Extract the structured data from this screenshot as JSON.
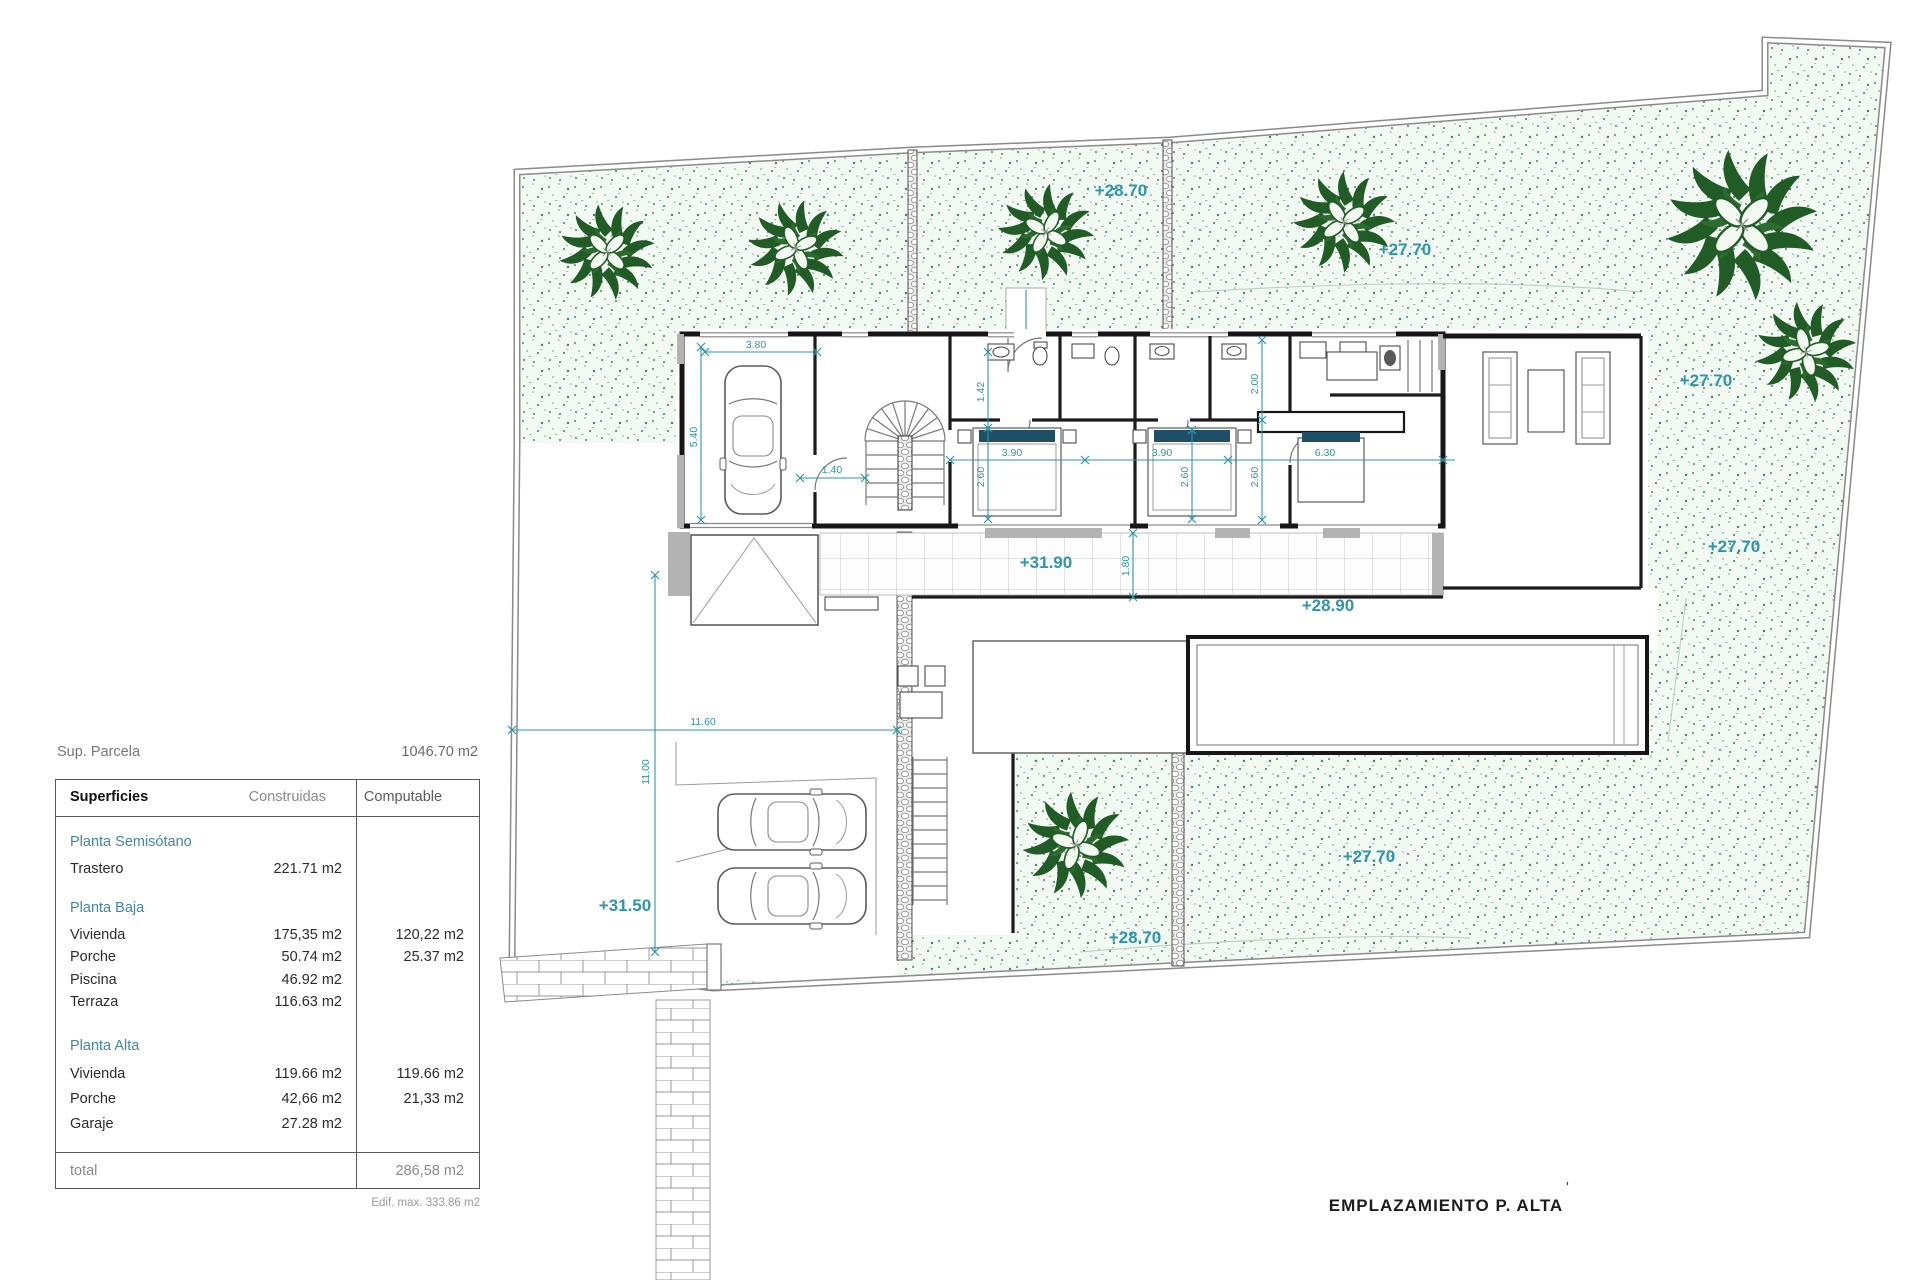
{
  "colors": {
    "garden_fill": "#f2f9f3",
    "plant_green": "#215b25",
    "dimension_teal": "#2e96ab",
    "section_title_blue": "#3e87a8",
    "wall_black": "#161616",
    "pillow_navy": "#1d4f66",
    "poche_grey": "#b3b3b3",
    "boundary_grey": "#8a8a8a"
  },
  "panel": {
    "sup_parcela_label": "Sup. Parcela",
    "sup_parcela_value": "1046.70 m2",
    "table": {
      "col_headers": {
        "superficies": "Superficies",
        "construidas": "Construidas",
        "computable": "Computable"
      },
      "sections": [
        {
          "title": "Planta Semisótano",
          "rows": [
            {
              "name": "Trastero",
              "construidas": "221.71 m2",
              "computable": ""
            }
          ]
        },
        {
          "title": "Planta Baja",
          "rows": [
            {
              "name": "Vivienda",
              "construidas": "175,35 m2",
              "computable": "120,22 m2"
            },
            {
              "name": "Porche",
              "construidas": "50.74 m2",
              "computable": "25.37 m2"
            },
            {
              "name": "Piscina",
              "construidas": "46.92 m2",
              "computable": ""
            },
            {
              "name": "Terraza",
              "construidas": "116.63 m2",
              "computable": ""
            }
          ]
        },
        {
          "title": "Planta Alta",
          "rows": [
            {
              "name": "Vivienda",
              "construidas": "119.66 m2",
              "computable": "119.66 m2"
            },
            {
              "name": "Porche",
              "construidas": "42,66 m2",
              "computable": "21,33 m2"
            },
            {
              "name": "Garaje",
              "construidas": "27.28 m2",
              "computable": ""
            }
          ]
        }
      ],
      "total_label": "total",
      "total_value": "286,58 m2",
      "footnote": "Edif. max. 333.86 m2"
    }
  },
  "plan": {
    "title": "EMPLAZAMIENTO P. ALTA",
    "title_tick": "'",
    "levels": [
      "+28.70",
      "+27.70",
      "+27.70",
      "+27.70",
      "+31.90",
      "+28.90",
      "+27.70",
      "+28.70",
      "+31.50"
    ],
    "dims": [
      "3.80",
      "5.40",
      "1.40",
      "1.42",
      "3.90",
      "2.60",
      "3.90",
      "2.60",
      "2.00",
      "2.60",
      "6.30",
      "1.80",
      "11.60",
      "11.00"
    ]
  }
}
